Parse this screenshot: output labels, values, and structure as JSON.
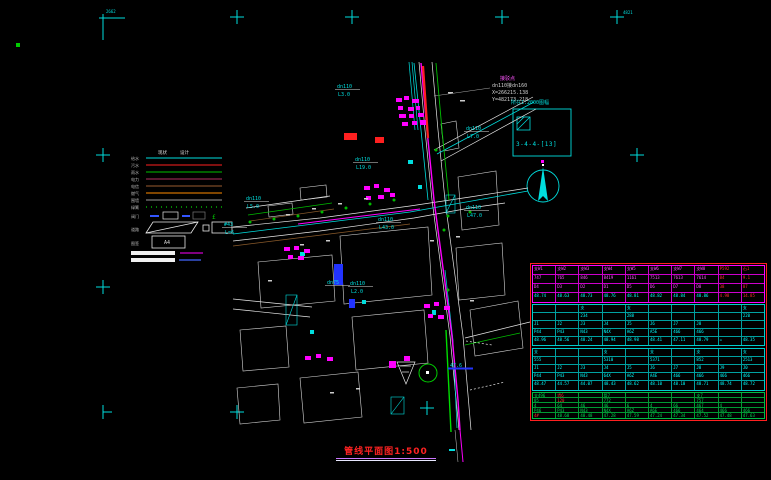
{
  "drawing": {
    "title": {
      "text": "管线平面图1:500"
    },
    "sheet_ref": {
      "label": "所在1:2000图幅",
      "number": "3-4-4-[13]"
    },
    "connection_note": {
      "line1": "接驳点",
      "line2": "dn110接dn160",
      "line3": "X=266215.138",
      "line4": "Y=482173.218"
    },
    "grid_labels": {
      "top_left": "2662",
      "top_right": "4821"
    }
  },
  "legend": {
    "col_headers": [
      "现状",
      "设计"
    ],
    "line_rows": [
      {
        "label": "给水",
        "color": "#00dede",
        "style": "solid"
      },
      {
        "label": "污水",
        "color": "#ff2020",
        "style": "solid"
      },
      {
        "label": "雨水",
        "color": "#00c000",
        "style": "solid"
      },
      {
        "label": "电力",
        "color": "#b03060",
        "style": "solid"
      },
      {
        "label": "电信",
        "color": "#9a5b2f",
        "style": "solid"
      },
      {
        "label": "燃气",
        "color": "#ff8c00",
        "style": "solid"
      },
      {
        "label": "围墙",
        "color": "#9a9a9a",
        "style": "solid"
      },
      {
        "label": "绿篱",
        "color": "#00b000",
        "style": "dotted"
      }
    ],
    "symbol_row_label": "阀门",
    "symbol_glyph": "£",
    "road_row_label": "道路",
    "frame_row_label": "图签",
    "frame_box_text": "A4"
  },
  "map": {
    "labels": [
      {
        "l1": "dn110",
        "l2": "L3.0",
        "x": 337,
        "y": 88,
        "box": false
      },
      {
        "l1": "dn110",
        "l2": "L7.0",
        "x": 466,
        "y": 130,
        "box": false
      },
      {
        "l1": "dn110",
        "l2": "L19.0",
        "x": 355,
        "y": 161,
        "box": false
      },
      {
        "l1": "dn110",
        "l2": "L5.0",
        "x": 246,
        "y": 200,
        "box": false
      },
      {
        "l1": "#43",
        "l2": "L=6",
        "x": 224,
        "y": 226,
        "box": false
      },
      {
        "l1": "dn110",
        "l2": "L47.0",
        "x": 466,
        "y": 209,
        "box": false
      },
      {
        "l1": "dn110",
        "l2": "L43.0",
        "x": 378,
        "y": 221,
        "box": false
      },
      {
        "l1": "dn110",
        "l2": "L2.0",
        "x": 350,
        "y": 285,
        "box": false
      },
      {
        "l1": "dn75",
        "l2": "",
        "x": 327,
        "y": 284,
        "box": false
      },
      {
        "l1": "47.6",
        "l2": "",
        "x": 450,
        "y": 367,
        "box": true
      }
    ]
  },
  "frame": {
    "marks": [
      {
        "x": 237,
        "y": 17,
        "t": "cross"
      },
      {
        "x": 352,
        "y": 17,
        "t": "cross"
      },
      {
        "x": 502,
        "y": 17,
        "t": "cross"
      },
      {
        "x": 617,
        "y": 17,
        "t": "cross"
      },
      {
        "x": 103,
        "y": 155,
        "t": "cross"
      },
      {
        "x": 103,
        "y": 287,
        "t": "cross"
      },
      {
        "x": 103,
        "y": 412,
        "t": "tick"
      },
      {
        "x": 237,
        "y": 412,
        "t": "cross"
      },
      {
        "x": 427,
        "y": 408,
        "t": "cross"
      },
      {
        "x": 637,
        "y": 155,
        "t": "cross"
      }
    ]
  },
  "table": {
    "sections": [
      {
        "frame": "#ff00ff",
        "grid": "#cc00cc",
        "text": "#ff55ff",
        "value_text": "#00ffff",
        "h": 38,
        "value_rows": [
          3
        ],
        "red_cols": [
          8,
          9
        ],
        "red_cells": [],
        "rows": [
          [
            "支W1",
            "支W2",
            "支W3",
            "支W4",
            "支W5",
            "支W6",
            "支W7",
            "支W8",
            "P592",
            "石1"
          ],
          [
            "747",
            "765",
            "846",
            "8419",
            "1161",
            "7513",
            "7613",
            "7614",
            "84",
            "9.1"
          ],
          [
            "D4",
            "D3",
            "D2",
            "D1",
            "D5",
            "D6",
            "D7",
            "D8",
            "38",
            "87"
          ],
          [
            "48.74",
            "48.63",
            "48.73",
            "48.76",
            "48.81",
            "48.82",
            "48.84",
            "48.86",
            "4.98",
            "14.85"
          ]
        ]
      },
      {
        "frame": "#00cccc",
        "grid": "#00a0a0",
        "text": "#00ffff",
        "value_text": "#00ffff",
        "h": 42,
        "value_rows": [],
        "red_cols": [],
        "red_cells": [],
        "rows": [
          [
            "",
            "",
            "支",
            "",
            "支",
            "",
            "",
            "",
            "",
            "支"
          ],
          [
            "",
            "",
            "234",
            "",
            "288",
            "",
            "",
            "",
            "",
            "220"
          ],
          [
            "J1",
            "J2",
            "J3",
            "J4",
            "J5",
            "J6",
            "J7",
            "J8",
            "",
            ""
          ],
          [
            "P44",
            "P43",
            "N43",
            "N4X",
            "A6Z",
            "A5E",
            "466",
            "466",
            "",
            ""
          ],
          [
            "48.96",
            "48.56",
            "48.24",
            "48.94",
            "48.98",
            "48.41",
            "47.11",
            "48.79",
            "=",
            "48.35"
          ]
        ]
      },
      {
        "frame": "#00cccc",
        "grid": "#00a0a0",
        "text": "#00ffff",
        "value_text": "#00ffff",
        "h": 43,
        "value_rows": [],
        "red_cols": [],
        "red_cells": [],
        "rows": [
          [
            "支",
            "",
            "",
            "支",
            "",
            "支",
            "",
            "支",
            "",
            "支"
          ],
          [
            "555",
            "",
            "",
            "5310",
            "",
            "5371",
            "",
            "852",
            "",
            "2513"
          ],
          [
            "J1",
            "J2",
            "J3",
            "J4",
            "J5",
            "J6",
            "J7",
            "J8",
            "J9",
            "J0"
          ],
          [
            "P44",
            "P43",
            "N43",
            "64X",
            "A6Z",
            "A4E",
            "466",
            "466",
            "466",
            "466"
          ],
          [
            "48.47",
            "44.57",
            "44.07",
            "48.43",
            "48.62",
            "48.10",
            "48.10",
            "48.71",
            "48.74",
            "48.72"
          ]
        ]
      },
      {
        "frame": "#00bb44",
        "grid": "#009933",
        "text": "#00dd55",
        "value_text": "#00dd55",
        "h": 27,
        "value_rows": [],
        "red_cols": [],
        "red_cells": [
          [
            0,
            1
          ],
          [
            1,
            1
          ],
          [
            4,
            0
          ]
        ],
        "rows": [
          [
            "支496",
            "墙6",
            "",
            "管7",
            "",
            "",
            "",
            "支7",
            "",
            ""
          ],
          [
            "85",
            "120",
            "",
            "772",
            "",
            "",
            "",
            "757",
            "",
            ""
          ],
          [
            "4",
            "64",
            "46",
            "46",
            "6",
            "4",
            "66",
            "467",
            "4",
            ""
          ],
          [
            "P46",
            "P43",
            "N43",
            "N4X",
            "A6Z",
            "A6E",
            "466",
            "464",
            "466",
            "466"
          ],
          [
            "4#",
            "48.68",
            "48.48",
            "47.28",
            "47.59",
            "47.24",
            "47.34",
            "47.52",
            "47.48",
            "47.63"
          ]
        ]
      }
    ]
  }
}
